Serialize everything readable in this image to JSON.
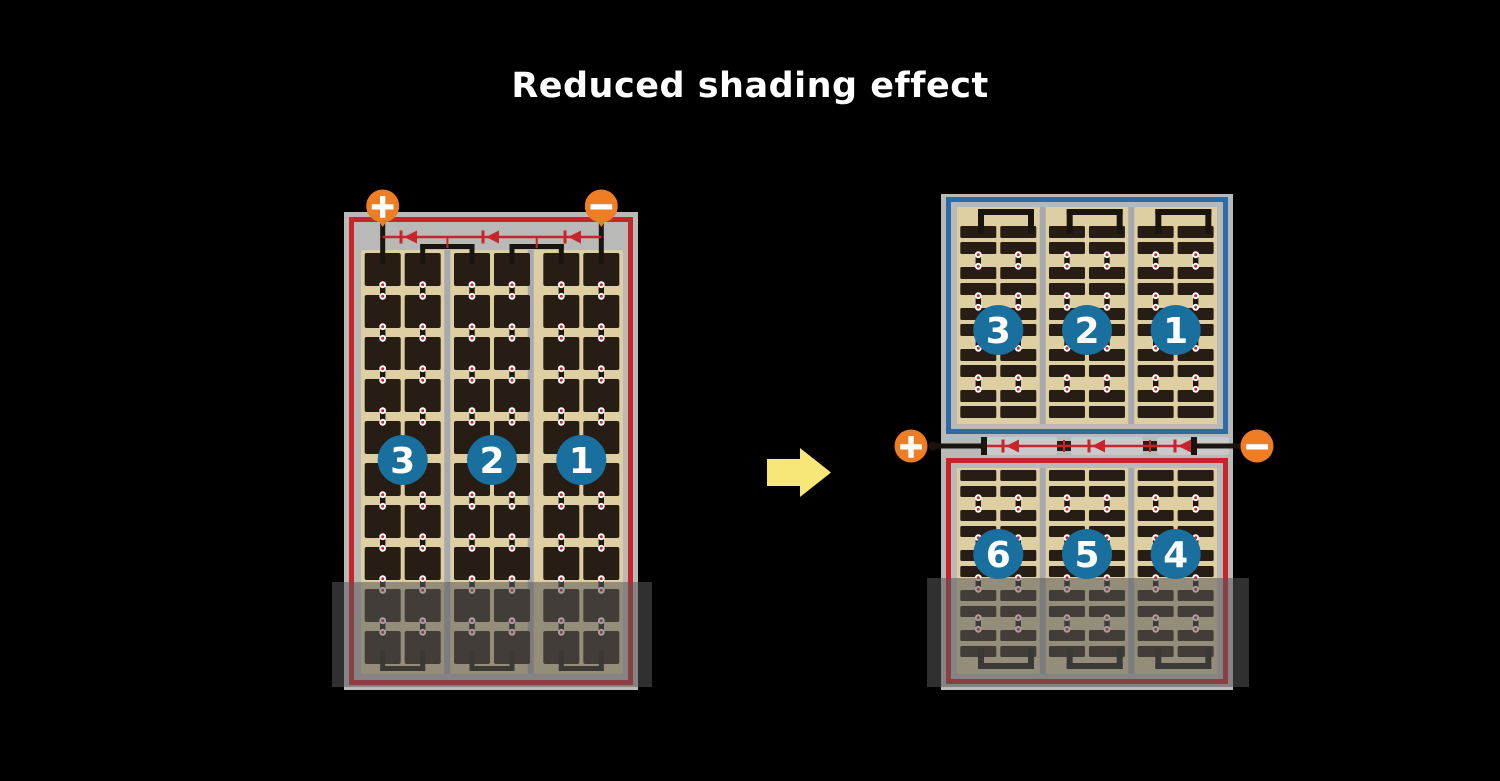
{
  "title": "Reduced shading effect",
  "left_panel": {
    "terminal_positive": "+",
    "terminal_negative": "−",
    "string_labels": [
      "3",
      "2",
      "1"
    ]
  },
  "right_panel": {
    "terminal_positive": "+",
    "terminal_negative": "−",
    "top_string_labels": [
      "3",
      "2",
      "1"
    ],
    "bottom_string_labels": [
      "6",
      "5",
      "4"
    ]
  },
  "colors": {
    "background": "#000000",
    "title_text": "#ffffff",
    "frame_gray": "#b9bab8",
    "panel_tan": "#ddcfa2",
    "cell_dark": "#281d15",
    "divider_gray": "#a6a9ae",
    "border_red": "#c8242b",
    "border_blue": "#2e6ba6",
    "diode_red": "#c8242b",
    "wire_black": "#1a140e",
    "terminal_orange": "#ee7d23",
    "terminal_glyph": "#ffffff",
    "circle_blue": "#19709e",
    "circle_text": "#ffffff",
    "solder_white": "#ffffff",
    "solder_red": "#c9242b",
    "junction_box": "#c9c9c9",
    "arrow_yellow": "#f7e678",
    "shade_overlay": "rgba(88,88,88,0.55)"
  }
}
